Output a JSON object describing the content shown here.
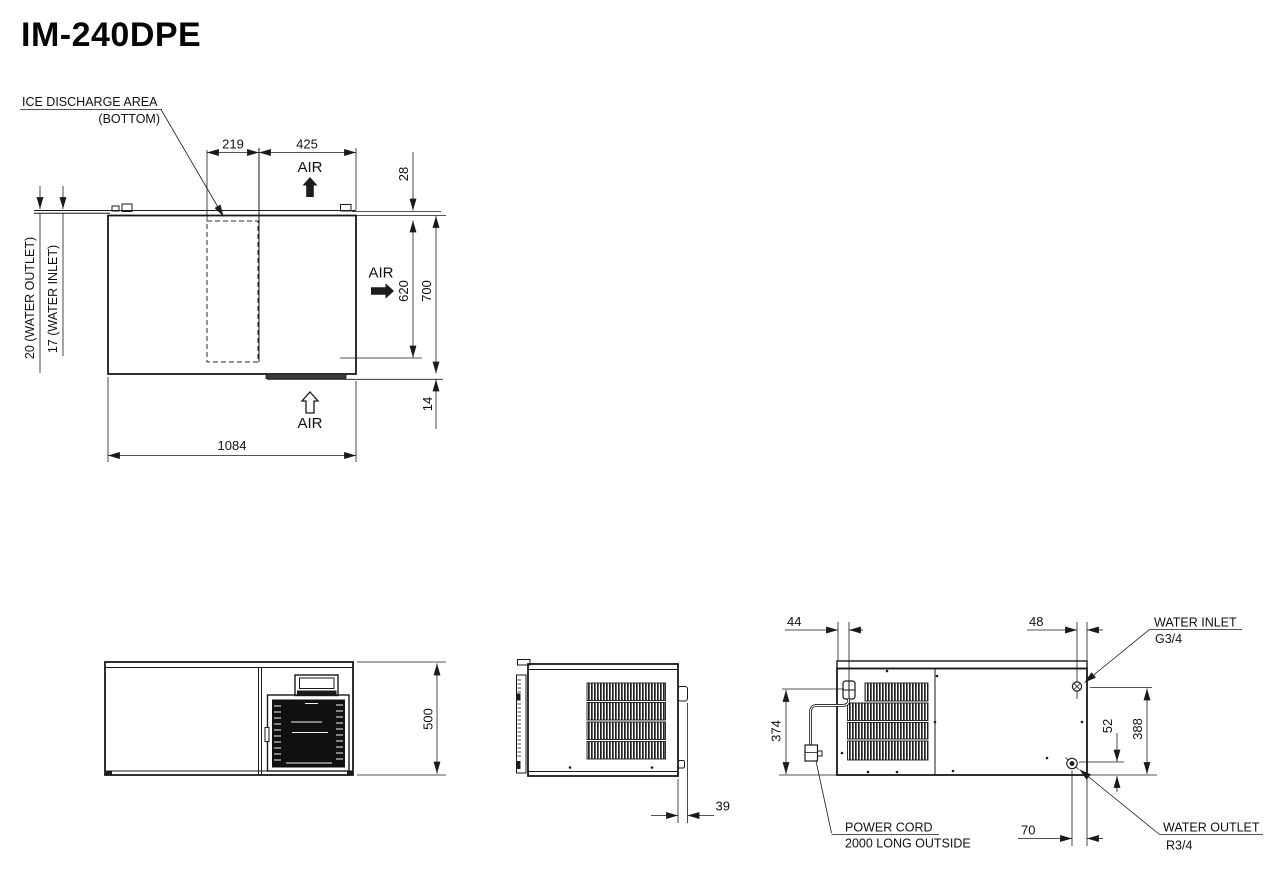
{
  "title": "IM-240DPE",
  "colors": {
    "line": "#1a1a1a",
    "background": "#ffffff"
  },
  "top_view": {
    "ice_discharge_label": "ICE DISCHARGE AREA",
    "ice_discharge_sub": "(BOTTOM)",
    "air_top": "AIR",
    "air_side": "AIR",
    "air_bottom": "AIR",
    "dim_discharge_width": "219",
    "dim_air_width": "425",
    "dim_rear_offset": "28",
    "dim_air_depth": "620",
    "dim_depth": "700",
    "dim_front_offset": "14",
    "dim_overall_width": "1084",
    "dim_water_outlet": "20 (WATER OUTLET)",
    "dim_water_inlet": "17 (WATER INLET)"
  },
  "front_view": {
    "dim_height": "500"
  },
  "side_view": {
    "dim_protrusion": "39"
  },
  "rear_view": {
    "dim_cord_offset": "44",
    "dim_inlet_offset": "48",
    "dim_cord_height": "374",
    "dim_outlet_height": "52",
    "dim_inlet_height": "388",
    "dim_outlet_offset": "70",
    "water_inlet_label": "WATER INLET",
    "water_inlet_thread": "G3/4",
    "water_outlet_label": "WATER OUTLET",
    "water_outlet_thread": "R3/4",
    "power_cord_label": "POWER CORD",
    "power_cord_note": "2000 LONG OUTSIDE"
  }
}
